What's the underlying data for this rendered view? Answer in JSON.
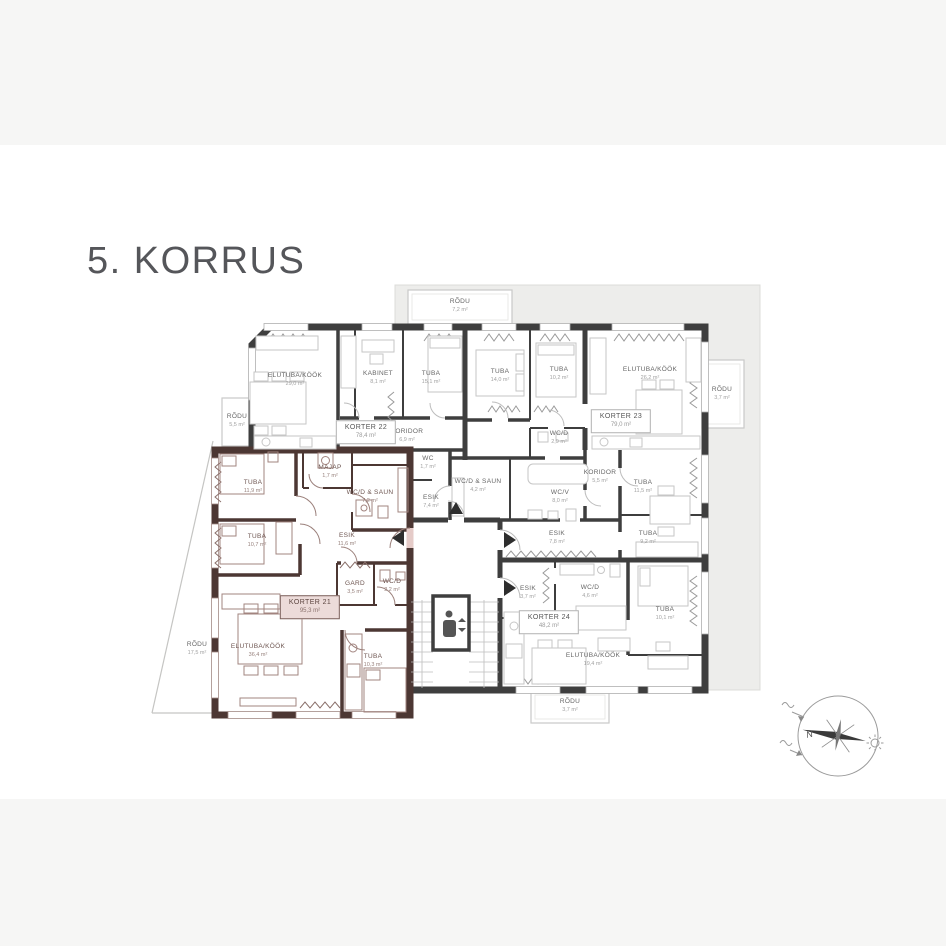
{
  "title": "5. KORRUS",
  "apartments": [
    {
      "label": "KORTER 21",
      "area": "95,3 m²",
      "highlighted": true,
      "x": 310,
      "y": 607
    },
    {
      "label": "KORTER 22",
      "area": "78,4 m²",
      "highlighted": false,
      "x": 366,
      "y": 432
    },
    {
      "label": "KORTER 23",
      "area": "79,0 m²",
      "highlighted": false,
      "x": 621,
      "y": 421
    },
    {
      "label": "KORTER 24",
      "area": "48,2 m²",
      "highlighted": false,
      "x": 549,
      "y": 622
    }
  ],
  "rooms": [
    {
      "label": "TUBA",
      "area": "11,9 m²",
      "zone": "pink",
      "x": 253,
      "y": 487
    },
    {
      "label": "MAJAP",
      "area": "1,7 m²",
      "zone": "pink",
      "x": 330,
      "y": 472
    },
    {
      "label": "WC/D & SAUN",
      "area": "7,2 m²",
      "zone": "pink",
      "x": 370,
      "y": 497
    },
    {
      "label": "TUBA",
      "area": "10,7 m²",
      "zone": "pink",
      "x": 257,
      "y": 541
    },
    {
      "label": "ESIK",
      "area": "11,6 m²",
      "zone": "pink",
      "x": 347,
      "y": 540
    },
    {
      "label": "GARD",
      "area": "3,5 m²",
      "zone": "pink",
      "x": 355,
      "y": 588
    },
    {
      "label": "WC/D",
      "area": "2,2 m²",
      "zone": "pink",
      "x": 392,
      "y": 586
    },
    {
      "label": "ELUTUBA/KÖÖK",
      "area": "36,4 m²",
      "zone": "pink",
      "x": 258,
      "y": 651
    },
    {
      "label": "TUBA",
      "area": "10,3 m²",
      "zone": "pink",
      "x": 373,
      "y": 661
    },
    {
      "label": "ELUTUBA/KÖÖK",
      "area": "29,0 m²",
      "zone": "white",
      "x": 295,
      "y": 380
    },
    {
      "label": "KABINET",
      "area": "8,1 m²",
      "zone": "white",
      "x": 378,
      "y": 378
    },
    {
      "label": "TUBA",
      "area": "15,1 m²",
      "zone": "white",
      "x": 431,
      "y": 378
    },
    {
      "label": "KORIDOR",
      "area": "6,9 m²",
      "zone": "white",
      "x": 407,
      "y": 436
    },
    {
      "label": "WC",
      "area": "1,7 m²",
      "zone": "white",
      "x": 428,
      "y": 463
    },
    {
      "label": "ESIK",
      "area": "7,4 m²",
      "zone": "white",
      "x": 431,
      "y": 502
    },
    {
      "label": "TUBA",
      "area": "14,0 m²",
      "zone": "white",
      "x": 500,
      "y": 376
    },
    {
      "label": "TUBA",
      "area": "10,2 m²",
      "zone": "white",
      "x": 559,
      "y": 374
    },
    {
      "label": "ELUTUBA/KÖÖK",
      "area": "26,2 m²",
      "zone": "white",
      "x": 650,
      "y": 374
    },
    {
      "label": "WC/D",
      "area": "2,9 m²",
      "zone": "white",
      "x": 559,
      "y": 438
    },
    {
      "label": "WC/D & SAUN",
      "area": "4,2 m²",
      "zone": "white",
      "x": 478,
      "y": 486
    },
    {
      "label": "WC/V",
      "area": "8,0 m²",
      "zone": "white",
      "x": 560,
      "y": 497
    },
    {
      "label": "KORIDOR",
      "area": "5,5 m²",
      "zone": "white",
      "x": 600,
      "y": 477
    },
    {
      "label": "TUBA",
      "area": "11,5 m²",
      "zone": "white",
      "x": 643,
      "y": 487
    },
    {
      "label": "ESIK",
      "area": "7,8 m²",
      "zone": "white",
      "x": 557,
      "y": 538
    },
    {
      "label": "TUBA",
      "area": "9,2 m²",
      "zone": "white",
      "x": 648,
      "y": 538
    },
    {
      "label": "ESIK",
      "area": "3,7 m²",
      "zone": "white",
      "x": 528,
      "y": 593
    },
    {
      "label": "WC/D",
      "area": "4,6 m²",
      "zone": "white",
      "x": 590,
      "y": 592
    },
    {
      "label": "ELUTUBA/KÖÖK",
      "area": "19,4 m²",
      "zone": "white",
      "x": 593,
      "y": 660
    },
    {
      "label": "TUBA",
      "area": "10,1 m²",
      "zone": "white",
      "x": 665,
      "y": 614
    }
  ],
  "balconies": [
    {
      "label": "RÕDU",
      "area": "7,2 m²",
      "x": 460,
      "y": 306
    },
    {
      "label": "RÕDU",
      "area": "3,7 m²",
      "x": 722,
      "y": 394
    },
    {
      "label": "RÕDU",
      "area": "5,5 m²",
      "x": 237,
      "y": 421
    },
    {
      "label": "RÕDU",
      "area": "17,5 m²",
      "x": 197,
      "y": 649
    },
    {
      "label": "RÕDU",
      "area": "3,7 m²",
      "x": 570,
      "y": 706
    }
  ],
  "compass": {
    "north_label": "N"
  },
  "colors": {
    "highlight_fill": "#e5cbc8",
    "highlight_wall": "#4c3733",
    "wall": "#3e3e3e",
    "terrace": "#ededeb",
    "title": "#55565a"
  }
}
